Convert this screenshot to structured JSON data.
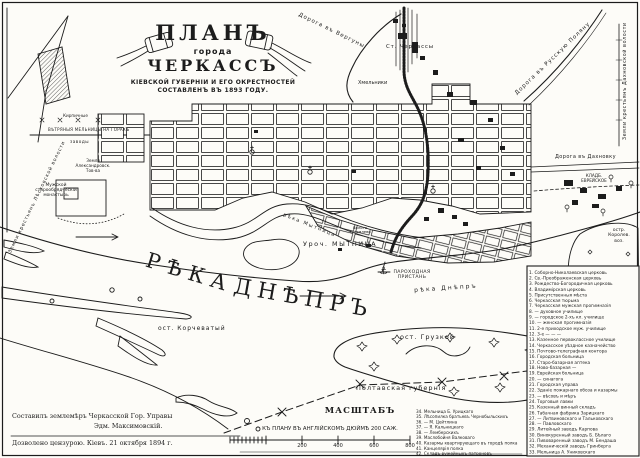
{
  "colors": {
    "ink": "#1c1c1c",
    "paper": "#fdfcf8"
  },
  "title": {
    "word_plan": "ПЛАНЪ",
    "word_goroda": "города",
    "word_city": "ЧЕРКАССЪ",
    "subtitle_line1": "КІЕВСКОЙ ГУБЕРНІИ И ЕГО ОКРЕСТНОСТЕЙ",
    "subtitle_line2": "СОСТАВЛЕНЪ ВЪ 1893 ГОДУ."
  },
  "roads": {
    "verguny": "Дорога въ Вергуны",
    "russkaya_polyana": "Дорога въ Русскую Поляну",
    "dakhnovka": "Дорога въ Дахновку"
  },
  "areas": {
    "station": "Ст. Черкассы",
    "khmelniki": "Хмельники",
    "lands_dakhnovskaya": "Земли крестьянъ Дахновской волости",
    "lands_leskovskaya": "Земли крестьянъ Лѣсковской волости",
    "windmills": "ВѢТРЯНЫЯ МЕЛЬНИЦЫ НА ГОРАХЪ",
    "brick_works": "Кирпичные",
    "zavody": "заводы",
    "alexandrov_land": "Земля\nАлександровск.\nТов-ва",
    "monastery": "Мужской\nстарообрядческій\nмонастырь",
    "jewish_cemetery": "КЛАДБ.\nЕВРЕЙСКОЕ"
  },
  "water": {
    "reka_mytnitsa": "рѣка Мытница",
    "uroch_mytnitsa": "Уроч.  МЫТНИЦА",
    "boloto": "Болото\nТукомлево",
    "pier": "ПАРОХОДНАЯ\nПРИСТАНЬ",
    "reka_dnepr_small": "рѣка Днѣпръ",
    "reka_big": "РѢКА",
    "dnepr_big": "ДНѢПРЪ",
    "ost_korchevaty": "ост. Корчеватый",
    "ost_gruzkoy": "ост. Грузкой",
    "ost_korolev": "остр.\nКоролев.\nвоз.",
    "poltava": "Полтавская губернія"
  },
  "icons": {
    "anchor": "⚓"
  },
  "legend": {
    "items": [
      "1. Соборно-Николаевская церковь",
      "2. Св.-Преображенская церковь",
      "3. Рождество-Богородичная церковь",
      "4. Владимірская церковь",
      "5. Присутственныя мѣста",
      "6. Черкасская тюрьма",
      "7. Черкасская мужская прогимназія",
      "8. —  духовное училище",
      "9. —  городское 2-хъ кл. училище",
      "10. —  женская прогимназія",
      "11. 2-е приходское муж. училище",
      "12. 3-е  —  —  —",
      "13. Казенное первоклассное училище",
      "14. Черкасское уѣздное казначейство",
      "15. Почтово-телеграфная контора",
      "16. Городская больница",
      "17. Старо-базарная аптека",
      "18. Ново-базарная  —",
      "19. Еврейская больница",
      "20. —  синагога",
      "21. Городская управа",
      "22. Зданіе пожарнаго обоза и казармы",
      "23. —  вѣсовъ и мѣръ",
      "24. Торговыя лавки",
      "25. Казенный винный складъ",
      "26. Табачная фабрика Зарицкаго",
      "27. —  Литвиновскаго и Тальковскаго",
      "28. —  Павловскаго",
      "29. Литейный заводъ Карпова",
      "30. Винокуренный заводъ Б. Бѣлаго",
      "31. Пивоваренный заводъ М. Бендаша",
      "32. Механическій заводъ Гринберга",
      "33. Мельница А. Униковскаго"
    ],
    "items_bottom": [
      "34. Мельница Б. Урицкаго",
      "35. Лѣсопилка братьевъ Чернобыльскихъ",
      "36. —  М. Цейтлина",
      "37. —  Я. Кальницкаго",
      "38. —  Лемберскихъ",
      "39. Маслобойня Валковаго",
      "40. Казармы квартирующаго въ городѣ полка",
      "41. Канцелярія полка",
      "42. Складъ ружейныхъ патроновъ"
    ]
  },
  "scale": {
    "title": "МАСШТАБЪ",
    "subtitle": "КЪ ПЛАНУ ВЪ АНГЛІЙСКОМЪ ДЮЙМѢ 200 САЖ.",
    "tick_200": "200",
    "tick_400": "400",
    "tick_600": "600",
    "tick_800": "800"
  },
  "credits": {
    "line1": "Составилъ землемѣръ Черкасской Гор. Управы",
    "line2": "Эдм. Максимовскій.",
    "line3": "Дозволено цензурою. Кіевъ. 21 октября 1894 г."
  }
}
